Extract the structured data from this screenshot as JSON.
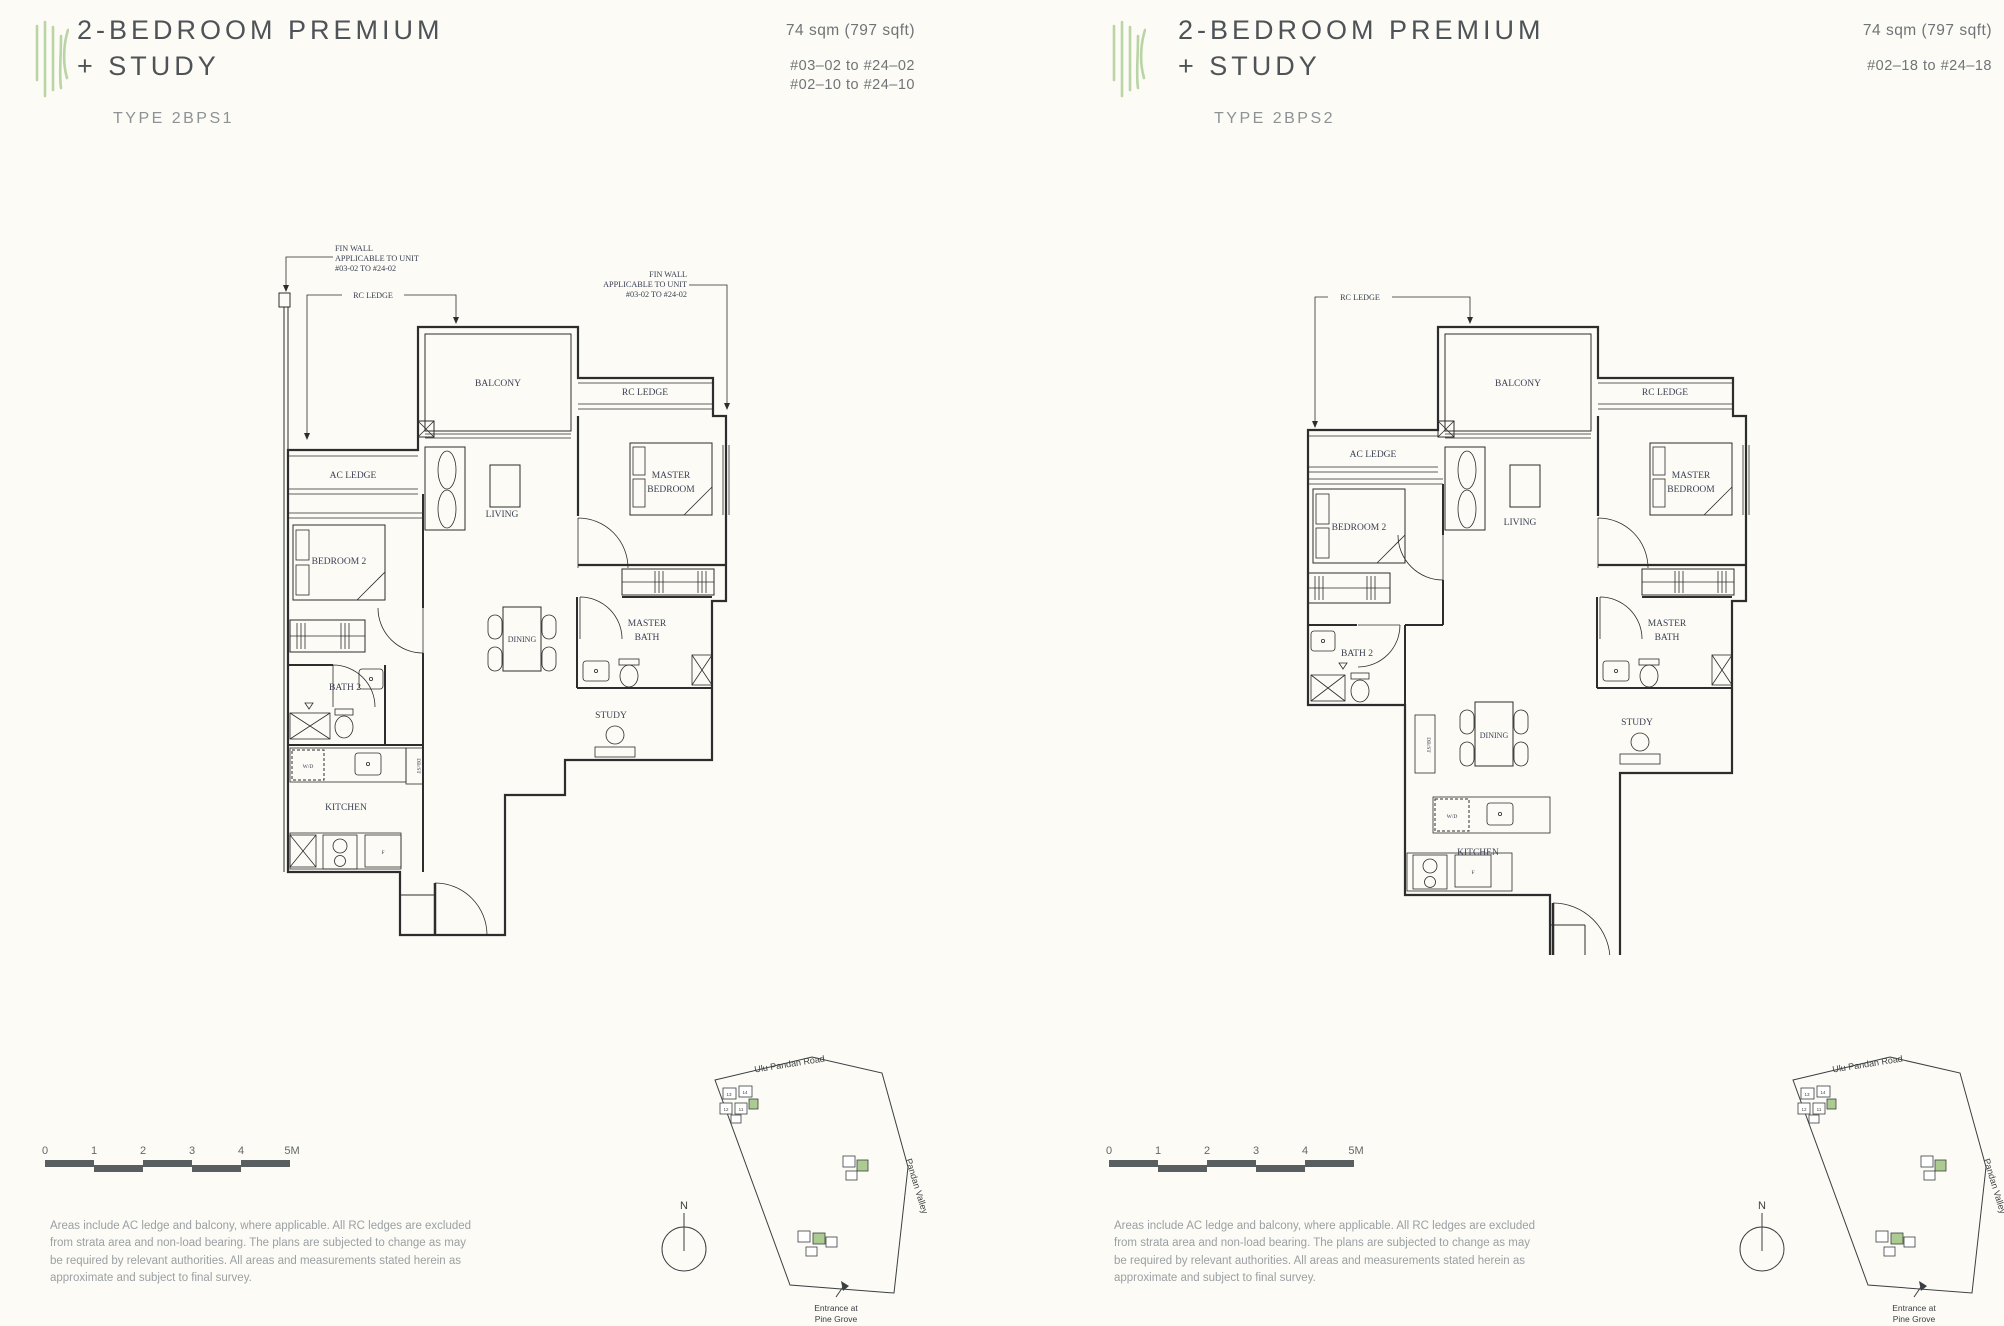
{
  "page": {
    "background": "#fcfbf5",
    "accent_green": "#b9d4a5",
    "plan_line_color": "#2d2d2d",
    "label_color": "#3a4154"
  },
  "units": [
    {
      "title_line1": "2-BEDROOM PREMIUM",
      "title_line2": "+ STUDY",
      "type_label": "TYPE 2BPS1",
      "area": "74 sqm (797 sqft)",
      "unit_ranges": [
        "#03–02 to #24–02",
        "#02–10 to #24–10"
      ],
      "callouts": {
        "fin_wall_left": [
          "FIN WALL",
          "APPLICABLE TO UNIT",
          "#03-02 TO #24-02"
        ],
        "fin_wall_right": [
          "FIN WALL",
          "APPLICABLE TO UNIT",
          "#03-02 TO #24-02"
        ],
        "rc_ledge": "RC LEDGE"
      },
      "rooms": {
        "balcony": "BALCONY",
        "rc_ledge": "RC LEDGE",
        "ac_ledge": "AC LEDGE",
        "living": "LIVING",
        "master_bedroom": [
          "MASTER",
          "BEDROOM"
        ],
        "bedroom_2": "BEDROOM 2",
        "dining": "DINING",
        "master_bath": [
          "MASTER",
          "BATH"
        ],
        "bath_2": "BATH 2",
        "study": "STUDY",
        "kitchen": "KITCHEN",
        "wd": "W/D",
        "db_st": "DB/ST",
        "f": "F"
      }
    },
    {
      "title_line1": "2-BEDROOM PREMIUM",
      "title_line2": "+ STUDY",
      "type_label": "TYPE 2BPS2",
      "area": "74 sqm (797 sqft)",
      "unit_ranges": [
        "#02–18 to #24–18"
      ],
      "callouts": {
        "rc_ledge": "RC LEDGE"
      },
      "rooms": {
        "balcony": "BALCONY",
        "rc_ledge": "RC LEDGE",
        "ac_ledge": "AC LEDGE",
        "living": "LIVING",
        "master_bedroom": [
          "MASTER",
          "BEDROOM"
        ],
        "bedroom_2": "BEDROOM 2",
        "dining": "DINING",
        "master_bath": [
          "MASTER",
          "BATH"
        ],
        "bath_2": "BATH 2",
        "study": "STUDY",
        "kitchen": "KITCHEN",
        "wd": "W/D",
        "db_st": "DB/ST",
        "f": "F"
      }
    }
  ],
  "footer": {
    "scale_labels": [
      "0",
      "1",
      "2",
      "3",
      "4",
      "5M"
    ],
    "disclaimer": "Areas include AC ledge and balcony, where applicable. All RC ledges are excluded from strata area and non-load bearing. The plans are subjected to change as may be required by relevant authorities. All areas and measurements stated herein as approximate and subject to final survey.",
    "site_map": {
      "road_label": "Ulu Pandan Road",
      "valley_label": "Pandan Valley",
      "entrance_label": [
        "Entrance at",
        "Pine Grove"
      ],
      "north_label": "N",
      "building_numbers": [
        "13",
        "14",
        "12",
        "11"
      ]
    }
  }
}
